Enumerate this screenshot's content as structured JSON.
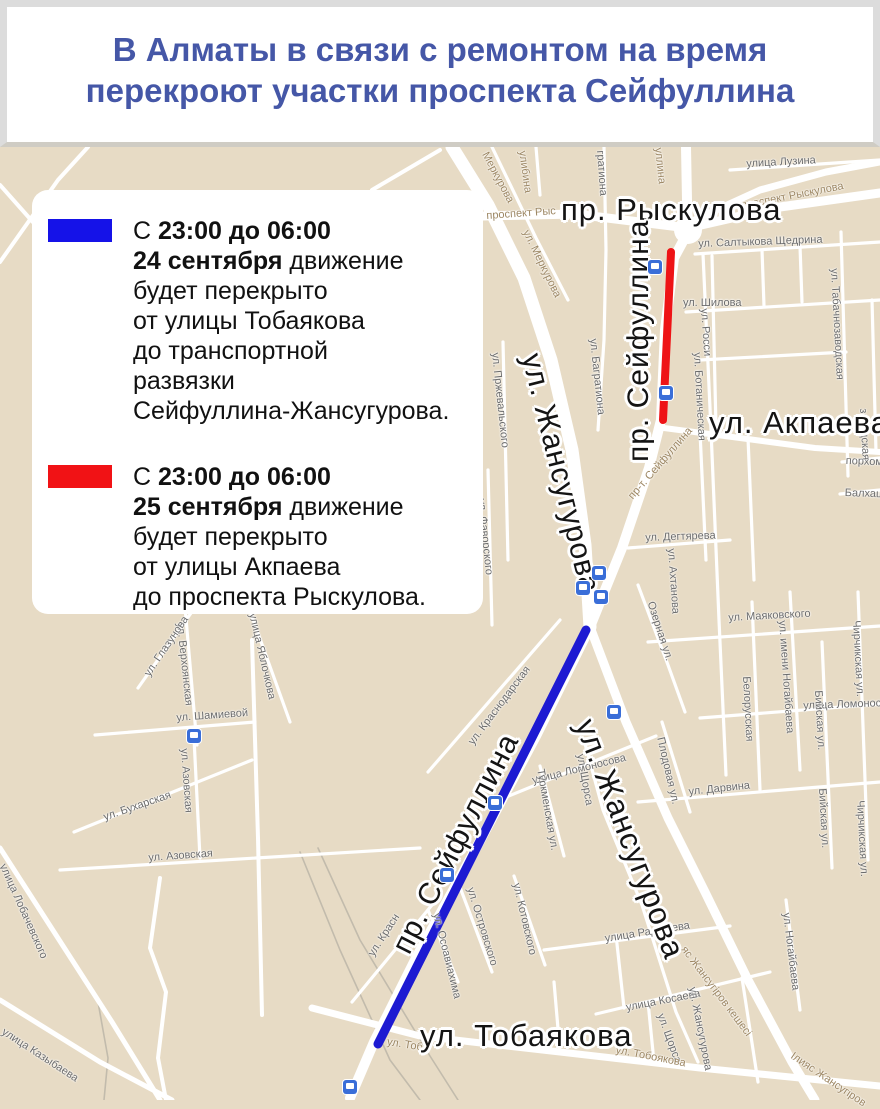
{
  "header": {
    "title_line1": "В Алматы в связи с ремонтом на время",
    "title_line2": "перекроют участки проспекта Сейфуллина",
    "title_color": "#4557a7"
  },
  "legend": {
    "items": [
      {
        "swatch_color": "#1512e8",
        "lines": [
          [
            {
              "t": "С ",
              "b": false
            },
            {
              "t": "23:00 до 06:00",
              "b": true
            }
          ],
          [
            {
              "t": "24 сентября",
              "b": true
            },
            {
              "t": " движение",
              "b": false
            }
          ],
          [
            {
              "t": "будет перекрыто",
              "b": false
            }
          ],
          [
            {
              "t": "от улицы Тобаякова",
              "b": false
            }
          ],
          [
            {
              "t": "до транспортной",
              "b": false
            }
          ],
          [
            {
              "t": "развязки",
              "b": false
            }
          ],
          [
            {
              "t": "Сейфуллина-Жансугурова.",
              "b": false
            }
          ]
        ]
      },
      {
        "swatch_color": "#f11215",
        "lines": [
          [
            {
              "t": "С ",
              "b": false
            },
            {
              "t": "23:00 до 06:00",
              "b": true
            }
          ],
          [
            {
              "t": "25 сентября",
              "b": true
            },
            {
              "t": " движение",
              "b": false
            }
          ],
          [
            {
              "t": "будет перекрыто",
              "b": false
            }
          ],
          [
            {
              "t": "от улицы Акпаева",
              "b": false
            }
          ],
          [
            {
              "t": "до проспекта Рыскулова.",
              "b": false
            }
          ]
        ]
      }
    ]
  },
  "map": {
    "background_color": "#e7dbc5",
    "road_color": "#ffffff",
    "closures": [
      {
        "name": "closure-24-september",
        "color": "#1d1ad2",
        "x1": 586,
        "y1": 630,
        "x2": 378,
        "y2": 1044,
        "w": 9
      },
      {
        "name": "closure-25-september",
        "color": "#ee1316",
        "x1": 671,
        "y1": 252,
        "x2": 663,
        "y2": 420,
        "w": 8
      }
    ],
    "roundabout": {
      "cx": 688,
      "cy": 230,
      "r": 14
    },
    "major_labels": [
      {
        "t": "пр. Рыскулова",
        "x": 561,
        "y": 192,
        "r": 0,
        "s": 31
      },
      {
        "t": "ул. Акпаева",
        "x": 709,
        "y": 405,
        "r": 0,
        "s": 31
      },
      {
        "t": "пр. Сейфуллина",
        "x": 622,
        "y": 462,
        "r": -90,
        "s": 30
      },
      {
        "t": "ул. Жансугурова",
        "x": 547,
        "y": 350,
        "r": 76,
        "s": 30
      },
      {
        "t": "пр. Сейфуллина",
        "x": 386,
        "y": 944,
        "r": -63,
        "s": 30
      },
      {
        "t": "ул. Жансугурова",
        "x": 601,
        "y": 714,
        "r": 69,
        "s": 31
      },
      {
        "t": "ул. Тобаякова",
        "x": 420,
        "y": 1018,
        "r": 0,
        "s": 31
      }
    ],
    "minor_labels": [
      {
        "t": "улица Лузина",
        "x": 746,
        "y": 158,
        "r": -3
      },
      {
        "t": "проспект Рыскулова",
        "x": 740,
        "y": 200,
        "r": -11,
        "c": "b"
      },
      {
        "t": "проспект Рыс",
        "x": 486,
        "y": 210,
        "r": -4,
        "c": "b"
      },
      {
        "t": "улибина",
        "x": 528,
        "y": 150,
        "r": 82,
        "c": "b"
      },
      {
        "t": "Меркурова",
        "x": 490,
        "y": 150,
        "r": 62,
        "c": "b"
      },
      {
        "t": "ул. Меркурова",
        "x": 531,
        "y": 228,
        "r": 64,
        "c": "b"
      },
      {
        "t": "уллина",
        "x": 664,
        "y": 147,
        "r": 84,
        "c": "b"
      },
      {
        "t": "гратиона",
        "x": 606,
        "y": 150,
        "r": 86
      },
      {
        "t": "ул. Салтыкова Щедрина",
        "x": 698,
        "y": 238,
        "r": -2
      },
      {
        "t": "ул. Шилова",
        "x": 683,
        "y": 297,
        "r": 0
      },
      {
        "t": "ул. Росси",
        "x": 710,
        "y": 308,
        "r": 86
      },
      {
        "t": "ул. Табачнозаводская",
        "x": 840,
        "y": 268,
        "r": 87
      },
      {
        "t": "ул. Ботаническая",
        "x": 703,
        "y": 352,
        "r": 87
      },
      {
        "t": "ул. Багратиона",
        "x": 599,
        "y": 338,
        "r": 84
      },
      {
        "t": "пр-т. Сейфуллина",
        "x": 626,
        "y": 494,
        "r": -49,
        "c": "b"
      },
      {
        "t": "порхоме",
        "x": 846,
        "y": 455,
        "r": 2
      },
      {
        "t": "Балхаш",
        "x": 845,
        "y": 487,
        "r": 2
      },
      {
        "t": "заводская",
        "x": 869,
        "y": 408,
        "r": 87
      },
      {
        "t": "ул. Дегтярева",
        "x": 645,
        "y": 532,
        "r": -2
      },
      {
        "t": "ул. Ахтанова",
        "x": 677,
        "y": 548,
        "r": 86
      },
      {
        "t": "ул. Пржевальского",
        "x": 501,
        "y": 352,
        "r": 84
      },
      {
        "t": "ул. Фаворского",
        "x": 487,
        "y": 498,
        "r": 84
      },
      {
        "t": "Озерная ул.",
        "x": 656,
        "y": 600,
        "r": 72
      },
      {
        "t": "ул. Маяковского",
        "x": 728,
        "y": 612,
        "r": -3
      },
      {
        "t": "ул. имени Ногайбаева",
        "x": 788,
        "y": 620,
        "r": 86
      },
      {
        "t": "Белорусская",
        "x": 752,
        "y": 676,
        "r": 87
      },
      {
        "t": "улица Ломоносова",
        "x": 803,
        "y": 700,
        "r": -2
      },
      {
        "t": "Чирчикская ул.",
        "x": 862,
        "y": 620,
        "r": 87
      },
      {
        "t": "Чирчикская ул.",
        "x": 866,
        "y": 800,
        "r": 87
      },
      {
        "t": "Бийская ул.",
        "x": 824,
        "y": 690,
        "r": 87
      },
      {
        "t": "Бийская ул.",
        "x": 828,
        "y": 788,
        "r": 87
      },
      {
        "t": "Плодовая ул.",
        "x": 666,
        "y": 736,
        "r": 77
      },
      {
        "t": "ул. Дарвина",
        "x": 688,
        "y": 786,
        "r": -6
      },
      {
        "t": "улица Ломоносова",
        "x": 531,
        "y": 775,
        "r": -14
      },
      {
        "t": "Туркменская ул.",
        "x": 546,
        "y": 768,
        "r": 80
      },
      {
        "t": "ул. Щорса",
        "x": 586,
        "y": 753,
        "r": 80
      },
      {
        "t": "ул. Щорса",
        "x": 666,
        "y": 1012,
        "r": 70
      },
      {
        "t": "ул. Котовского",
        "x": 522,
        "y": 882,
        "r": 77
      },
      {
        "t": "ул. Островского",
        "x": 476,
        "y": 886,
        "r": 73
      },
      {
        "t": "ул. Осоавиахима",
        "x": 442,
        "y": 912,
        "r": 76
      },
      {
        "t": "ул. Краснодарская",
        "x": 466,
        "y": 740,
        "r": -53
      },
      {
        "t": "ул. Красн",
        "x": 366,
        "y": 952,
        "r": -57
      },
      {
        "t": "улица Радищева",
        "x": 604,
        "y": 933,
        "r": -9
      },
      {
        "t": "улица Косаева",
        "x": 625,
        "y": 1002,
        "r": -11
      },
      {
        "t": "ул. Ногайбаева",
        "x": 792,
        "y": 912,
        "r": 83
      },
      {
        "t": "яс Жансугіров кешесі",
        "x": 688,
        "y": 944,
        "r": 53,
        "c": "b"
      },
      {
        "t": "Ілияс Жансугіров",
        "x": 795,
        "y": 1050,
        "r": 34,
        "c": "b"
      },
      {
        "t": "ул. Жансугурова",
        "x": 698,
        "y": 986,
        "r": 79
      },
      {
        "t": "ул. Тобоякова",
        "x": 617,
        "y": 1044,
        "r": 11,
        "c": "b"
      },
      {
        "t": "ул. Тоб",
        "x": 388,
        "y": 1036,
        "r": 9,
        "c": "b"
      },
      {
        "t": "ул. Шамиевой",
        "x": 176,
        "y": 712,
        "r": -4
      },
      {
        "t": "ул. Верхоянская",
        "x": 186,
        "y": 622,
        "r": 84
      },
      {
        "t": "ул. Глазунова",
        "x": 142,
        "y": 672,
        "r": -56
      },
      {
        "t": "улица Яблочкова",
        "x": 258,
        "y": 612,
        "r": 77
      },
      {
        "t": "ул. Азовская",
        "x": 190,
        "y": 748,
        "r": 86
      },
      {
        "t": "ул. Азовская",
        "x": 148,
        "y": 852,
        "r": -4
      },
      {
        "t": "ул. Бухарская",
        "x": 102,
        "y": 812,
        "r": -19
      },
      {
        "t": "улица Лобачевского",
        "x": 8,
        "y": 862,
        "r": 66
      },
      {
        "t": "улица Казыбаева",
        "x": 6,
        "y": 1026,
        "r": 33
      }
    ],
    "transit_icon_color": "#3a6ed8",
    "transit_icons": [
      {
        "x": 655,
        "y": 267
      },
      {
        "x": 666,
        "y": 393
      },
      {
        "x": 583,
        "y": 588
      },
      {
        "x": 599,
        "y": 573
      },
      {
        "x": 601,
        "y": 597
      },
      {
        "x": 614,
        "y": 712
      },
      {
        "x": 495,
        "y": 803
      },
      {
        "x": 447,
        "y": 875
      },
      {
        "x": 194,
        "y": 736
      },
      {
        "x": 350,
        "y": 1087
      }
    ],
    "roads_major": [
      {
        "p": "686,147 687,200 688,226",
        "w": 10
      },
      {
        "p": "688,232 674,258 665,330 661,420 649,468 622,548 590,627",
        "w": 10
      },
      {
        "p": "590,627 536,736 474,852 416,958 374,1042 350,1098",
        "w": 10
      },
      {
        "p": "452,147 488,205 524,278 551,360 572,450 585,545 590,627",
        "w": 13
      },
      {
        "p": "590,627 626,722 668,818 705,892 748,980 792,1062 815,1100",
        "w": 9
      },
      {
        "p": "483,216 575,214 688,228",
        "w": 9
      },
      {
        "p": "688,228 780,207 880,193",
        "w": 9
      },
      {
        "p": "690,222 760,190 826,172 880,162",
        "w": 7
      },
      {
        "p": "312,1008 420,1036 560,1052 700,1068 880,1086",
        "w": 7
      },
      {
        "p": "664,428 740,438 815,448 880,452",
        "w": 6
      }
    ],
    "roads_minor": [
      {
        "p": "730,170 880,160"
      },
      {
        "p": "695,254 880,242"
      },
      {
        "p": "686,312 880,300"
      },
      {
        "p": "700,360 846,352"
      },
      {
        "p": "712,256 716,428"
      },
      {
        "p": "762,250 764,306"
      },
      {
        "p": "800,246 802,302"
      },
      {
        "p": "841,232 848,476"
      },
      {
        "p": "872,300 876,452"
      },
      {
        "p": "703,254 711,430 719,620 726,775"
      },
      {
        "p": "842,462 880,458"
      },
      {
        "p": "840,494 880,490"
      },
      {
        "p": "700,432 706,560"
      },
      {
        "p": "748,438 754,580"
      },
      {
        "p": "628,548 730,540"
      },
      {
        "p": "503,342 508,560"
      },
      {
        "p": "488,470 492,625"
      },
      {
        "p": "638,585 668,665 685,712"
      },
      {
        "p": "648,642 880,626"
      },
      {
        "p": "790,592 800,770"
      },
      {
        "p": "752,602 760,790"
      },
      {
        "p": "700,718 880,704"
      },
      {
        "p": "858,592 868,860"
      },
      {
        "p": "822,642 832,868"
      },
      {
        "p": "638,802 880,782"
      },
      {
        "p": "662,722 690,812"
      },
      {
        "p": "494,802 656,736"
      },
      {
        "p": "540,766 564,856"
      },
      {
        "p": "584,740 603,810 642,905 676,1012 698,1062"
      },
      {
        "p": "514,876 545,965"
      },
      {
        "p": "458,882 492,972"
      },
      {
        "p": "428,910 458,982"
      },
      {
        "p": "428,772 560,620"
      },
      {
        "p": "352,1002 432,905"
      },
      {
        "p": "544,950 730,926"
      },
      {
        "p": "596,1014 770,972"
      },
      {
        "p": "786,900 800,1010"
      },
      {
        "p": "95,735 255,722"
      },
      {
        "p": "185,607 197,745"
      },
      {
        "p": "138,688 196,606"
      },
      {
        "p": "246,600 290,722"
      },
      {
        "p": "194,738 200,858"
      },
      {
        "p": "60,870 420,848"
      },
      {
        "p": "74,832 252,760"
      },
      {
        "p": "0,848 112,1022 160,1100",
        "w": 5
      },
      {
        "p": "0,1000 100,1062 172,1100",
        "w": 5
      },
      {
        "p": "252,640 258,838 262,1015",
        "w": 4
      },
      {
        "p": "160,878 150,948 166,992 158,1058 166,1100",
        "w": 4
      },
      {
        "p": "0,262 58,180 88,147",
        "w": 4
      },
      {
        "p": "0,185 40,230 78,268",
        "w": 4
      },
      {
        "p": "372,190 440,150",
        "w": 4
      },
      {
        "p": "536,147 540,195"
      },
      {
        "p": "604,147 606,250 604,340 598,430"
      },
      {
        "p": "492,147 536,238 568,300"
      },
      {
        "p": "742,978 758,1082"
      },
      {
        "p": "554,982 560,1052"
      },
      {
        "p": "648,1002 654,1062"
      },
      {
        "p": "616,935 624,1008"
      }
    ],
    "railways": [
      {
        "p": "300,852 340,950 390,1060 420,1100"
      },
      {
        "p": "318,848 360,940 430,1056 458,1100"
      },
      {
        "p": "98,1002 108,1058 104,1100"
      }
    ]
  }
}
